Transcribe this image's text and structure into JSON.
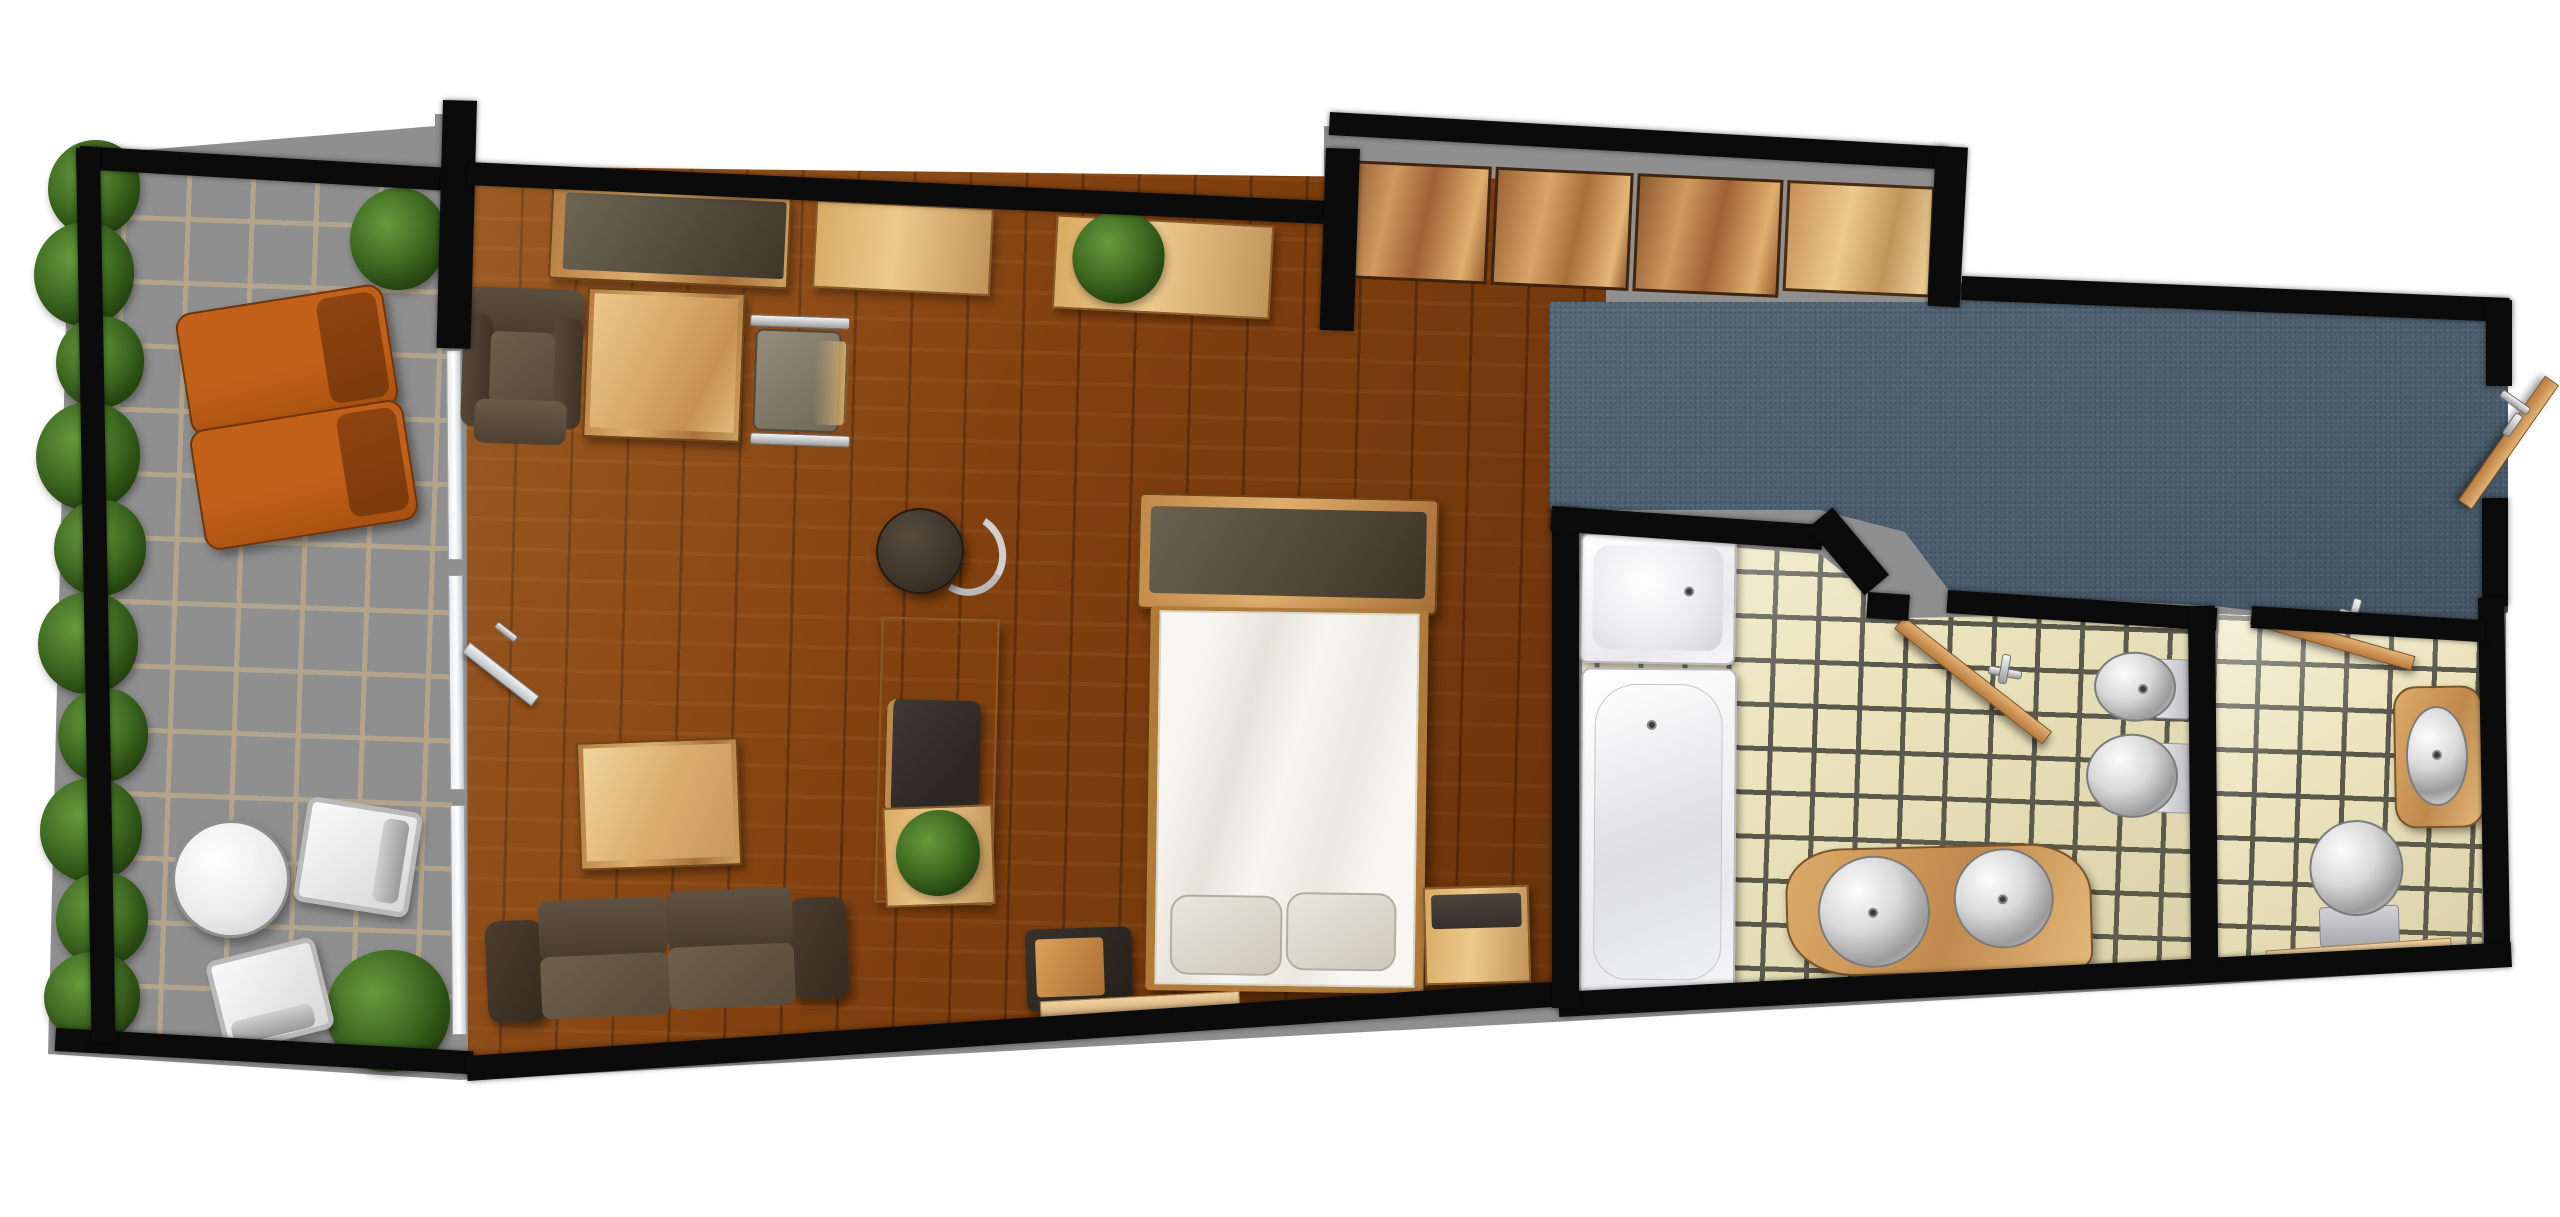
{
  "plan": {
    "title": "Hotel suite floor plan — top-down 3D render",
    "canvas": {
      "width": 2560,
      "height": 1217
    },
    "orientation": "long horizontal unit, terrace at left, entry and bathrooms at right"
  },
  "palette": {
    "bg": "#ffffff",
    "wall": "#0b0b0b",
    "wood-floor-1": "#81400f",
    "terrace-tile": "#ead9bd",
    "terrace-grout": "#b3a58c",
    "bath-tile": "#ece4bd",
    "bath-grout": "#5a584c",
    "carpet": "#4d6273",
    "closet-wood": "#c08a50",
    "light-wood": "#d8a860",
    "copper-wood": "#b9813f",
    "dark-seat": "#564737",
    "seat-light": "#6e604c",
    "orange": "#c2601a",
    "orange-dark": "#8f4410",
    "steel": "#c9c9c9",
    "white-fixture": "#f9f9f9",
    "plant-green": "#3f6b22"
  },
  "rooms": [
    {
      "id": "terrace",
      "name": "Terrace / balcony",
      "floor": "large beige tiles with hedge border"
    },
    {
      "id": "living",
      "name": "Living and sleeping area",
      "floor": "dark wood planks"
    },
    {
      "id": "hall",
      "name": "Entry hall",
      "floor": "blue-gray carpet"
    },
    {
      "id": "bathroom",
      "name": "Main bathroom",
      "floor": "cream mosaic tiles"
    },
    {
      "id": "wc",
      "name": "Separate WC",
      "floor": "cream mosaic tiles"
    }
  ],
  "furniture": {
    "terrace": [
      {
        "label": "hedge planting along left edge"
      },
      {
        "label": "sun lounger (orange)"
      },
      {
        "label": "sun lounger (orange)"
      },
      {
        "label": "round bistro table (white)"
      },
      {
        "label": "terrace chair (metal)"
      },
      {
        "label": "terrace chair (metal)"
      },
      {
        "label": "shrub (top)"
      },
      {
        "label": "shrub (bottom)"
      }
    ],
    "living": [
      {
        "label": "sideboard with dark top"
      },
      {
        "label": "armchair (brown leather)"
      },
      {
        "label": "writing desk"
      },
      {
        "label": "desk chair (chrome frame)"
      },
      {
        "label": "wall shelf"
      },
      {
        "label": "wall shelf with plant"
      },
      {
        "label": "bistro table with curved chrome chair"
      },
      {
        "label": "dresser / console"
      },
      {
        "label": "dark chair at dresser"
      },
      {
        "label": "potted plant"
      },
      {
        "label": "two-seat sofa (brown leather)"
      },
      {
        "label": "coffee table"
      },
      {
        "label": "planter box with plant"
      },
      {
        "label": "double bed with headboard panel"
      },
      {
        "label": "pillow"
      },
      {
        "label": "pillow"
      },
      {
        "label": "nightstand (dark, left of bed)"
      },
      {
        "label": "nightstand (wood, right of bed)"
      },
      {
        "label": "terrace sliding glass door"
      },
      {
        "label": "terrace door leaf (open)"
      }
    ],
    "hall": [
      {
        "label": "wardrobe closet, sliding door panel 1"
      },
      {
        "label": "wardrobe closet, sliding door panel 2"
      },
      {
        "label": "wardrobe closet, sliding door panel 3"
      },
      {
        "label": "wardrobe closet, sliding door panel 4 (light)"
      },
      {
        "label": "entrance door (open leaf with chrome handle)"
      }
    ],
    "bathroom": [
      {
        "label": "shower tray"
      },
      {
        "label": "bathtub"
      },
      {
        "label": "curved double vanity with two round basins"
      },
      {
        "label": "wall-hung bidet"
      },
      {
        "label": "wall-hung toilet"
      },
      {
        "label": "bathroom door (open leaf with chrome handle)"
      },
      {
        "label": "wooden threshold strip"
      }
    ],
    "wc": [
      {
        "label": "washbasin in wooden surround"
      },
      {
        "label": "toilet with cistern"
      },
      {
        "label": "door (open leaf with chrome handle)"
      },
      {
        "label": "wooden threshold strip"
      }
    ]
  }
}
